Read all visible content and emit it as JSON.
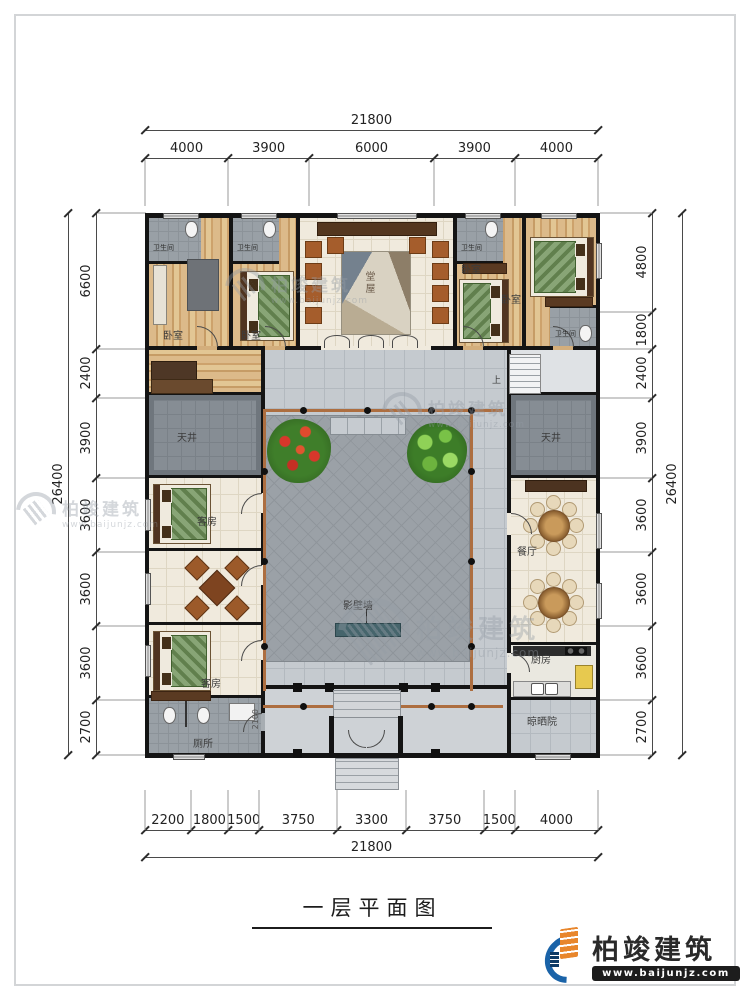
{
  "page": {
    "title": "一层平面图"
  },
  "watermark": {
    "name": "柏竣建筑",
    "url": "www.baijunjz.com"
  },
  "logo": {
    "name": "柏竣建筑",
    "url": "www.baijunjz.com"
  },
  "dimensions": {
    "top": {
      "total": "21800",
      "segments": [
        "4000",
        "3900",
        "6000",
        "3900",
        "4000"
      ]
    },
    "bottom": {
      "total": "21800",
      "segments": [
        "2200",
        "1800",
        "1500",
        "3750",
        "3300",
        "3750",
        "1500",
        "4000"
      ]
    },
    "left": {
      "total": "26400",
      "segments": [
        "6600",
        "2400",
        "3900",
        "3600",
        "3600",
        "3600",
        "2700"
      ]
    },
    "right": {
      "total": "26400",
      "segments": [
        "4800",
        "1800",
        "2400",
        "3900",
        "3600",
        "3600",
        "3600",
        "2700"
      ]
    }
  },
  "rooms": {
    "bedroom": "卧室",
    "bathroom": "卫生间",
    "hall": "堂屋",
    "skywell": "天井",
    "guestroom": "客房",
    "dining": "餐厅",
    "kitchen": "厨房",
    "toilet": "厕所",
    "screenwall": "影壁墙",
    "dryyard": "晾晒院",
    "up": "上",
    "inner_dim": "2100"
  }
}
